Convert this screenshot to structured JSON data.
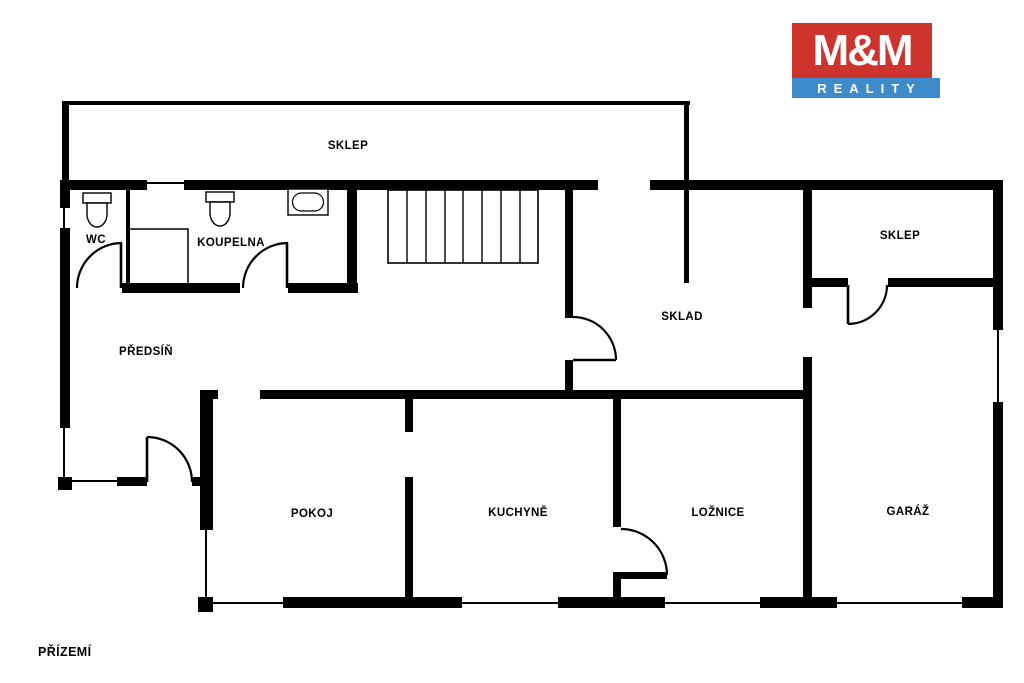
{
  "page": {
    "width": 1024,
    "height": 683,
    "background": "#ffffff",
    "wall_color": "#000000"
  },
  "floor_label": "PŘÍZEMÍ",
  "logo": {
    "top_text": "M&M",
    "bottom_text": "REALITY",
    "red": "#cd342e",
    "blue": "#3d8cc9",
    "text_color": "#ffffff"
  },
  "rooms": [
    {
      "id": "sklep-top",
      "label": "SKLEP",
      "cx": 348,
      "cy": 146
    },
    {
      "id": "wc",
      "label": "WC",
      "cx": 96,
      "cy": 240
    },
    {
      "id": "koupelna",
      "label": "KOUPELNA",
      "cx": 231,
      "cy": 243
    },
    {
      "id": "predsin",
      "label": "PŘEDSÍŇ",
      "cx": 146,
      "cy": 352
    },
    {
      "id": "sklad",
      "label": "SKLAD",
      "cx": 682,
      "cy": 317
    },
    {
      "id": "sklep-right",
      "label": "SKLEP",
      "cx": 900,
      "cy": 236
    },
    {
      "id": "pokoj",
      "label": "POKOJ",
      "cx": 312,
      "cy": 514
    },
    {
      "id": "kuchyne",
      "label": "KUCHYNĚ",
      "cx": 518,
      "cy": 513
    },
    {
      "id": "loznice",
      "label": "LOŽNICE",
      "cx": 718,
      "cy": 513
    },
    {
      "id": "garaz",
      "label": "GARÁŽ",
      "cx": 908,
      "cy": 512
    }
  ],
  "geometry": {
    "walls_thick": [
      [
        60,
        180,
        87,
        10
      ],
      [
        184,
        180,
        414,
        10
      ],
      [
        650,
        180,
        353,
        10
      ],
      [
        60,
        180,
        10,
        28
      ],
      [
        60,
        228,
        10,
        200
      ],
      [
        58,
        477,
        14,
        13
      ],
      [
        993,
        180,
        10,
        150
      ],
      [
        993,
        402,
        10,
        206
      ],
      [
        122,
        283,
        118,
        10
      ],
      [
        288,
        283,
        70,
        10
      ],
      [
        347,
        188,
        10,
        105
      ],
      [
        565,
        190,
        8,
        128
      ],
      [
        565,
        360,
        8,
        31
      ],
      [
        803,
        188,
        9,
        120
      ],
      [
        803,
        357,
        9,
        251
      ],
      [
        812,
        278,
        36,
        9
      ],
      [
        888,
        278,
        105,
        9
      ],
      [
        200,
        390,
        18,
        9
      ],
      [
        260,
        390,
        543,
        9
      ],
      [
        200,
        390,
        13,
        140
      ],
      [
        198,
        597,
        15,
        15
      ],
      [
        117,
        477,
        30,
        9
      ],
      [
        192,
        477,
        8,
        9
      ],
      [
        405,
        399,
        8,
        33
      ],
      [
        405,
        477,
        8,
        131
      ],
      [
        613,
        399,
        8,
        128
      ],
      [
        613,
        572,
        54,
        7
      ],
      [
        613,
        579,
        8,
        29
      ],
      [
        283,
        597,
        179,
        11
      ],
      [
        558,
        597,
        107,
        11
      ],
      [
        760,
        597,
        77,
        11
      ],
      [
        962,
        597,
        41,
        11
      ]
    ],
    "walls_medium": [
      [
        62,
        101,
        628,
        4
      ],
      [
        62,
        101,
        7,
        79
      ],
      [
        684,
        101,
        5,
        81
      ],
      [
        684,
        190,
        5,
        93
      ],
      [
        126,
        190,
        4,
        93
      ]
    ],
    "windows": [
      [
        63,
        208,
        2,
        20
      ],
      [
        63,
        428,
        2,
        49
      ],
      [
        70,
        480,
        47,
        2
      ],
      [
        205,
        530,
        2,
        67
      ],
      [
        997,
        330,
        2,
        72
      ],
      [
        213,
        602,
        70,
        2
      ],
      [
        462,
        602,
        96,
        2
      ],
      [
        665,
        602,
        95,
        2
      ],
      [
        837,
        602,
        125,
        2
      ],
      [
        147,
        182,
        37,
        2
      ]
    ],
    "doors": [
      {
        "id": "wc-door",
        "arc": "M 122 243 A 45 45 0 0 0 77 288",
        "leaf": [
          121,
          243,
          121,
          288
        ]
      },
      {
        "id": "koupelna-door",
        "arc": "M 288 243 A 45 45 0 0 0 243 288",
        "leaf": [
          287,
          243,
          287,
          288
        ]
      },
      {
        "id": "sklad-door",
        "arc": "M 573 317 A 43 43 0 0 1 616 360",
        "leaf": [
          573,
          360,
          616,
          360
        ]
      },
      {
        "id": "predsin-door",
        "arc": "M 147 437 A 45 45 0 0 1 192 482",
        "leaf": [
          147,
          437,
          147,
          482
        ]
      },
      {
        "id": "sklep-right-door",
        "arc": "M 887 285 A 39 39 0 0 1 848 324",
        "leaf": [
          848,
          285,
          848,
          324
        ]
      },
      {
        "id": "loznice-door",
        "arc": "M 621 529 A 46 46 0 0 1 667 575",
        "leaf": null
      }
    ],
    "stairs": {
      "x": 388,
      "y": 190,
      "w": 150,
      "h": 73,
      "treads_x": [
        407,
        426,
        445,
        463,
        482,
        501,
        520
      ]
    },
    "fixtures": {
      "toilets": [
        {
          "x": 83,
          "y": 193
        },
        {
          "x": 206,
          "y": 192
        }
      ],
      "bathtub": {
        "x": 288,
        "y": 189,
        "w": 40,
        "h": 26
      },
      "shower": {
        "points": "129,229 188,229 188,284"
      }
    }
  }
}
